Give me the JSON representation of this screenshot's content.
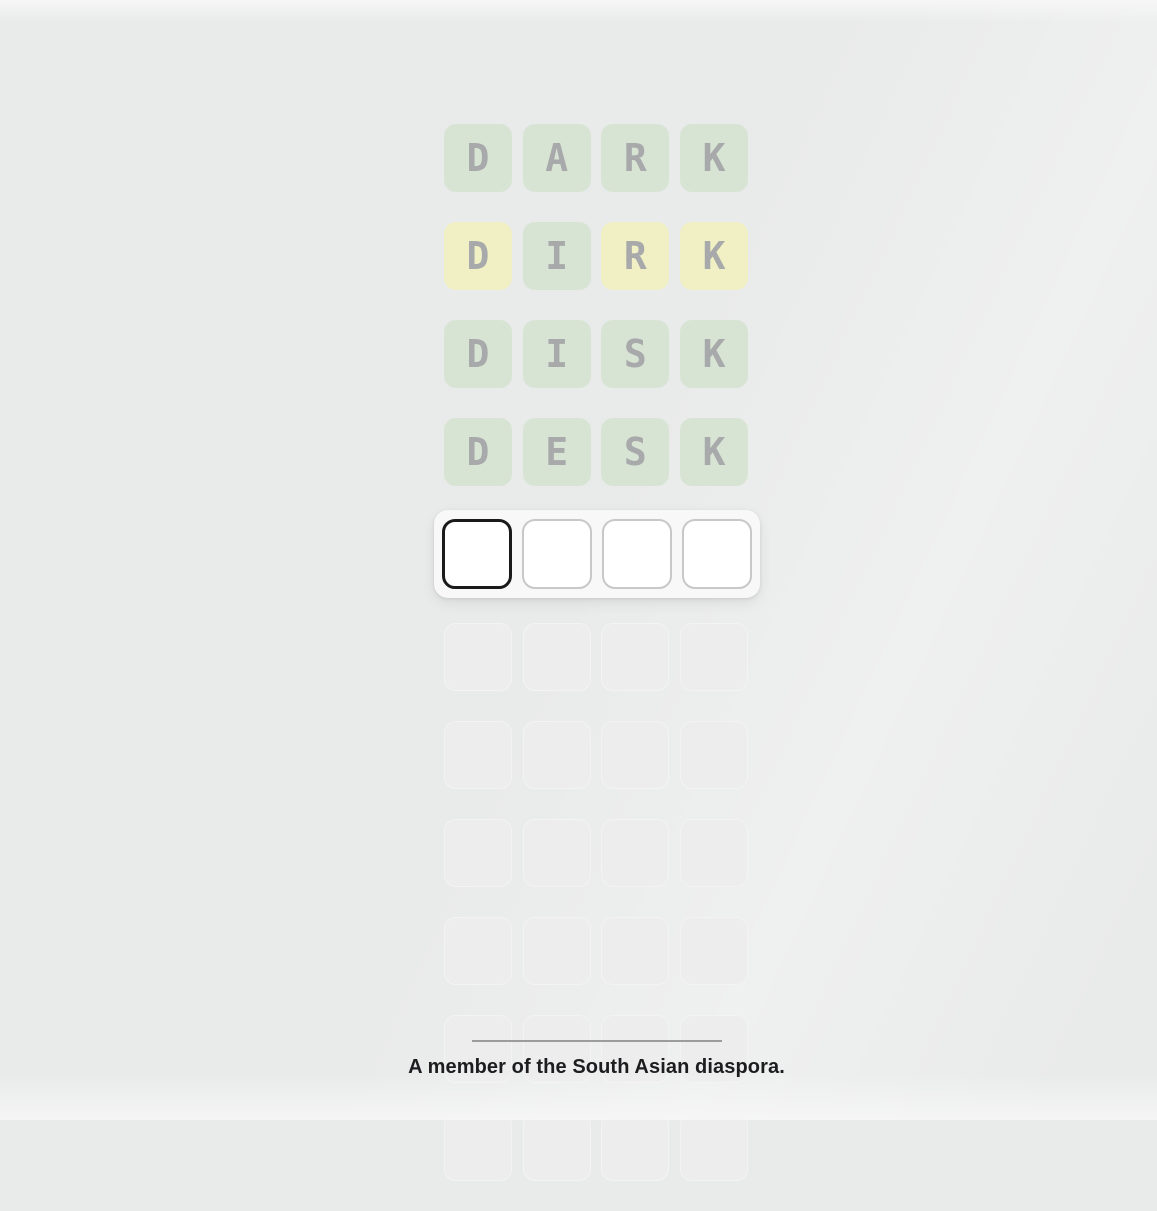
{
  "board": {
    "columns": 4,
    "rows": [
      {
        "type": "guess",
        "word": "DARK",
        "tiles": [
          {
            "letter": "D",
            "state": "correct"
          },
          {
            "letter": "A",
            "state": "correct"
          },
          {
            "letter": "R",
            "state": "correct"
          },
          {
            "letter": "K",
            "state": "correct"
          }
        ]
      },
      {
        "type": "guess",
        "word": "DIRK",
        "tiles": [
          {
            "letter": "D",
            "state": "present"
          },
          {
            "letter": "I",
            "state": "correct"
          },
          {
            "letter": "R",
            "state": "present"
          },
          {
            "letter": "K",
            "state": "present"
          }
        ]
      },
      {
        "type": "guess",
        "word": "DISK",
        "tiles": [
          {
            "letter": "D",
            "state": "correct"
          },
          {
            "letter": "I",
            "state": "correct"
          },
          {
            "letter": "S",
            "state": "correct"
          },
          {
            "letter": "K",
            "state": "correct"
          }
        ]
      },
      {
        "type": "guess",
        "word": "DESK",
        "tiles": [
          {
            "letter": "D",
            "state": "correct"
          },
          {
            "letter": "E",
            "state": "correct"
          },
          {
            "letter": "S",
            "state": "correct"
          },
          {
            "letter": "K",
            "state": "correct"
          }
        ]
      },
      {
        "type": "active",
        "tiles": [
          {
            "letter": "",
            "state": "focused"
          },
          {
            "letter": "",
            "state": "empty"
          },
          {
            "letter": "",
            "state": "empty"
          },
          {
            "letter": "",
            "state": "empty"
          }
        ]
      },
      {
        "type": "future"
      },
      {
        "type": "future"
      },
      {
        "type": "future"
      },
      {
        "type": "future"
      },
      {
        "type": "future"
      },
      {
        "type": "future"
      }
    ]
  },
  "clue": {
    "text": "A member of the South Asian diaspora."
  },
  "colors": {
    "background": "#e9eaea",
    "correct": "#d7e4d4",
    "present": "#f0f0c4",
    "letter": "#a8a9aa",
    "tile_future": "#ededee",
    "tile_future_border": "#f3f3f4",
    "active_card": "#f8f8f8",
    "tile_border": "#c7c8c9",
    "focus_border": "#1a1a1a",
    "divider": "#9c9c9c",
    "clue_text": "#1d1d1f"
  }
}
